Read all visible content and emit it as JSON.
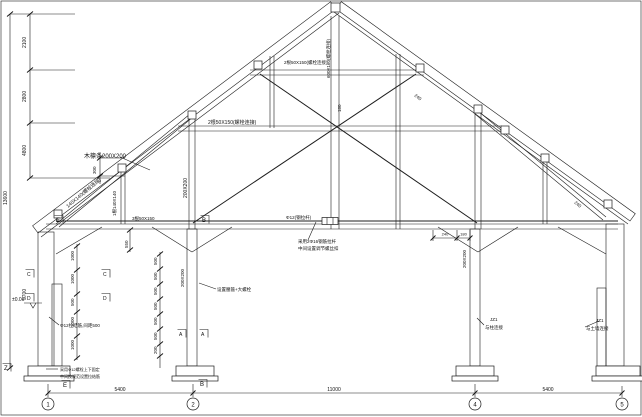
{
  "drawing": {
    "kind": "timber-roof-truss-section",
    "axes": [
      "1",
      "2",
      "4",
      "5"
    ],
    "bottom_dimensions": [
      "5400",
      "11000",
      "5400"
    ],
    "left_dimension_chain": [
      "2100",
      "2800",
      "4800",
      "13600",
      "5700",
      "300"
    ],
    "annotations": [
      {
        "name": "dim-seg-2100",
        "text": "2100",
        "x": 26,
        "y": 48,
        "rot": -90,
        "size": 5
      },
      {
        "name": "dim-seg-2800",
        "text": "2800",
        "x": 26,
        "y": 102,
        "rot": -90,
        "size": 5
      },
      {
        "name": "dim-seg-4800",
        "text": "4800",
        "x": 26,
        "y": 156,
        "rot": -90,
        "size": 5
      },
      {
        "name": "dim-total-13600",
        "text": "13600",
        "x": 7,
        "y": 205,
        "rot": -90,
        "size": 5
      },
      {
        "name": "dim-300",
        "text": "300",
        "x": 96,
        "y": 174,
        "rot": -90,
        "size": 4.5
      },
      {
        "name": "dim-5700",
        "text": "5700",
        "x": 26,
        "y": 300,
        "rot": -90,
        "size": 5
      },
      {
        "name": "wall-dim-1000a",
        "text": "1000",
        "x": 74,
        "y": 261,
        "rot": -90,
        "size": 4.5
      },
      {
        "name": "wall-dim-1000b",
        "text": "1000",
        "x": 74,
        "y": 284,
        "rot": -90,
        "size": 4.5
      },
      {
        "name": "wall-dim-500",
        "text": "500",
        "x": 74,
        "y": 306,
        "rot": -90,
        "size": 4.5
      },
      {
        "name": "wall-dim-1000c",
        "text": "1000",
        "x": 74,
        "y": 327,
        "rot": -90,
        "size": 4.5
      },
      {
        "name": "wall-dim-1000d",
        "text": "1000",
        "x": 74,
        "y": 350,
        "rot": -90,
        "size": 4.5
      },
      {
        "name": "col2-dim-500a",
        "text": "500",
        "x": 157,
        "y": 265,
        "rot": -90,
        "size": 4.5
      },
      {
        "name": "col2-dim-500b",
        "text": "500",
        "x": 157,
        "y": 280,
        "rot": -90,
        "size": 4.5
      },
      {
        "name": "col2-dim-500c",
        "text": "500",
        "x": 157,
        "y": 295,
        "rot": -90,
        "size": 4.5
      },
      {
        "name": "col2-dim-500d",
        "text": "500",
        "x": 157,
        "y": 310,
        "rot": -90,
        "size": 4.5
      },
      {
        "name": "col2-dim-500e",
        "text": "500",
        "x": 157,
        "y": 325,
        "rot": -90,
        "size": 4.5
      },
      {
        "name": "col2-dim-500f",
        "text": "500",
        "x": 157,
        "y": 340,
        "rot": -90,
        "size": 4.5
      },
      {
        "name": "col2-dim-200",
        "text": "200",
        "x": 157,
        "y": 354,
        "rot": -90,
        "size": 4.5
      },
      {
        "name": "purlin-note",
        "text": "木檩条200X200",
        "x": 84,
        "y": 158,
        "size": 6
      },
      {
        "name": "strut-left-label",
        "text": "140X140(螺栓连接)",
        "x": 68,
        "y": 208,
        "rot": -40,
        "size": 5
      },
      {
        "name": "post-left-label",
        "text": "1根140X140",
        "x": 116,
        "y": 216,
        "rot": -90,
        "size": 4.5
      },
      {
        "name": "dim-550",
        "text": "550",
        "x": 128,
        "y": 248,
        "rot": -90,
        "size": 4.5
      },
      {
        "name": "queen-left-label",
        "text": "200X200",
        "x": 187,
        "y": 198,
        "rot": -90,
        "size": 5
      },
      {
        "name": "collar2-label",
        "text": "2根50X150(螺栓连接)",
        "x": 208,
        "y": 124,
        "size": 5
      },
      {
        "name": "chord-label",
        "text": "3根50X150",
        "x": 132,
        "y": 220,
        "size": 4.5
      },
      {
        "name": "collar1-label",
        "text": "2根50X150(螺栓连接)",
        "x": 284,
        "y": 64,
        "size": 4.5
      },
      {
        "name": "kingpost-label",
        "text": "600X160(螺栓连接)",
        "x": 330,
        "y": 78,
        "rot": -90,
        "size": 4.5
      },
      {
        "name": "king-dim-180",
        "text": "180",
        "x": 341,
        "y": 112,
        "rot": -90,
        "size": 4.5
      },
      {
        "name": "diag-label-240",
        "text": "240",
        "x": 414,
        "y": 96,
        "rot": 38,
        "size": 4.5
      },
      {
        "name": "tierod-label",
        "text": "Φ12(钢拉杆)",
        "x": 286,
        "y": 219,
        "size": 4.5
      },
      {
        "name": "tierod-note-1",
        "text": "采用2Φ16钢筋拉杆",
        "x": 298,
        "y": 243,
        "size": 4.5
      },
      {
        "name": "tierod-note-2",
        "text": "中间设置调节螺丝扣",
        "x": 298,
        "y": 250,
        "size": 4.5
      },
      {
        "name": "col4-dim-240",
        "text": "240",
        "x": 445,
        "y": 235.5,
        "size": 4,
        "anchor": "middle"
      },
      {
        "name": "col4-dim-180",
        "text": "180",
        "x": 463.5,
        "y": 235.5,
        "size": 4,
        "anchor": "middle"
      },
      {
        "name": "col4-label",
        "text": "200X200",
        "x": 466,
        "y": 268,
        "rot": -90,
        "size": 4.5
      },
      {
        "name": "col4-note-jz1",
        "text": "JZ1",
        "x": 490,
        "y": 321,
        "size": 4.5
      },
      {
        "name": "col4-note-conn",
        "text": "与柱连接",
        "x": 485,
        "y": 329,
        "size": 4.5
      },
      {
        "name": "strut-right-dim-240",
        "text": "240",
        "x": 574,
        "y": 203,
        "rot": 40,
        "size": 4.5
      },
      {
        "name": "rwall-note-jz1",
        "text": "JZ1",
        "x": 596,
        "y": 322,
        "size": 4.5
      },
      {
        "name": "rwall-note-conn",
        "text": "与土墙连接",
        "x": 586,
        "y": 330,
        "size": 4.5
      },
      {
        "name": "col2-note",
        "text": "设置腰箍+大螺栓",
        "x": 217,
        "y": 291,
        "size": 4.5
      },
      {
        "name": "col2-label",
        "text": "200X200",
        "x": 184,
        "y": 287,
        "rot": -90,
        "size": 4.5
      },
      {
        "name": "wall-tie-note",
        "text": "Φ12拉结筋,间距500",
        "x": 60,
        "y": 327,
        "size": 4.5
      },
      {
        "name": "base-note-1",
        "text": "采用Φ12螺栓上下固定",
        "x": 60,
        "y": 371,
        "size": 4
      },
      {
        "name": "base-note-2",
        "text": "中间按规范设置拉结筋",
        "x": 60,
        "y": 378,
        "size": 4
      },
      {
        "name": "level-plusminus-0",
        "text": "±0.00",
        "x": 12,
        "y": 301,
        "size": 5
      },
      {
        "name": "marker-e-top",
        "text": "E",
        "x": 56,
        "y": 222,
        "size": 6,
        "bar": true
      },
      {
        "name": "marker-b-top",
        "text": "B",
        "x": 202,
        "y": 222,
        "size": 6,
        "bar": true
      },
      {
        "name": "marker-c-wall",
        "text": "C",
        "x": 27,
        "y": 276,
        "size": 5,
        "bar": true
      },
      {
        "name": "marker-c-inner",
        "text": "C",
        "x": 103,
        "y": 276,
        "size": 5,
        "bar": true
      },
      {
        "name": "marker-d-wall",
        "text": "D",
        "x": 27,
        "y": 300,
        "size": 5,
        "bar": true
      },
      {
        "name": "marker-d-inner",
        "text": "D",
        "x": 103,
        "y": 300,
        "size": 5,
        "bar": true
      },
      {
        "name": "marker-a-left",
        "text": "A",
        "x": 179,
        "y": 336,
        "size": 5,
        "bar": true
      },
      {
        "name": "marker-a-right",
        "text": "A",
        "x": 201,
        "y": 336,
        "size": 5,
        "bar": true
      },
      {
        "name": "marker-e-bottom",
        "text": "E",
        "x": 63,
        "y": 387,
        "size": 6,
        "bar": true
      },
      {
        "name": "marker-b-bottom",
        "text": "B",
        "x": 200,
        "y": 386,
        "size": 6,
        "bar": true
      },
      {
        "name": "marker-z",
        "text": "Z",
        "x": 4,
        "y": 370,
        "size": 6,
        "bar": true
      },
      {
        "name": "axis-label-1",
        "text": "1",
        "x": 48,
        "y": 406.5,
        "size": 6,
        "anchor": "middle"
      },
      {
        "name": "axis-label-2",
        "text": "2",
        "x": 193,
        "y": 406.5,
        "size": 6,
        "anchor": "middle"
      },
      {
        "name": "axis-label-4",
        "text": "4",
        "x": 475,
        "y": 406.5,
        "size": 6,
        "anchor": "middle"
      },
      {
        "name": "axis-label-5",
        "text": "5",
        "x": 622,
        "y": 406.5,
        "size": 6,
        "anchor": "middle"
      },
      {
        "name": "dim-5400-left",
        "text": "5400",
        "x": 120,
        "y": 391,
        "size": 5,
        "anchor": "middle"
      },
      {
        "name": "dim-11000",
        "text": "11000",
        "x": 334,
        "y": 391,
        "size": 5,
        "anchor": "middle"
      },
      {
        "name": "dim-5400-right",
        "text": "5400",
        "x": 548,
        "y": 391,
        "size": 5,
        "anchor": "middle"
      }
    ]
  }
}
